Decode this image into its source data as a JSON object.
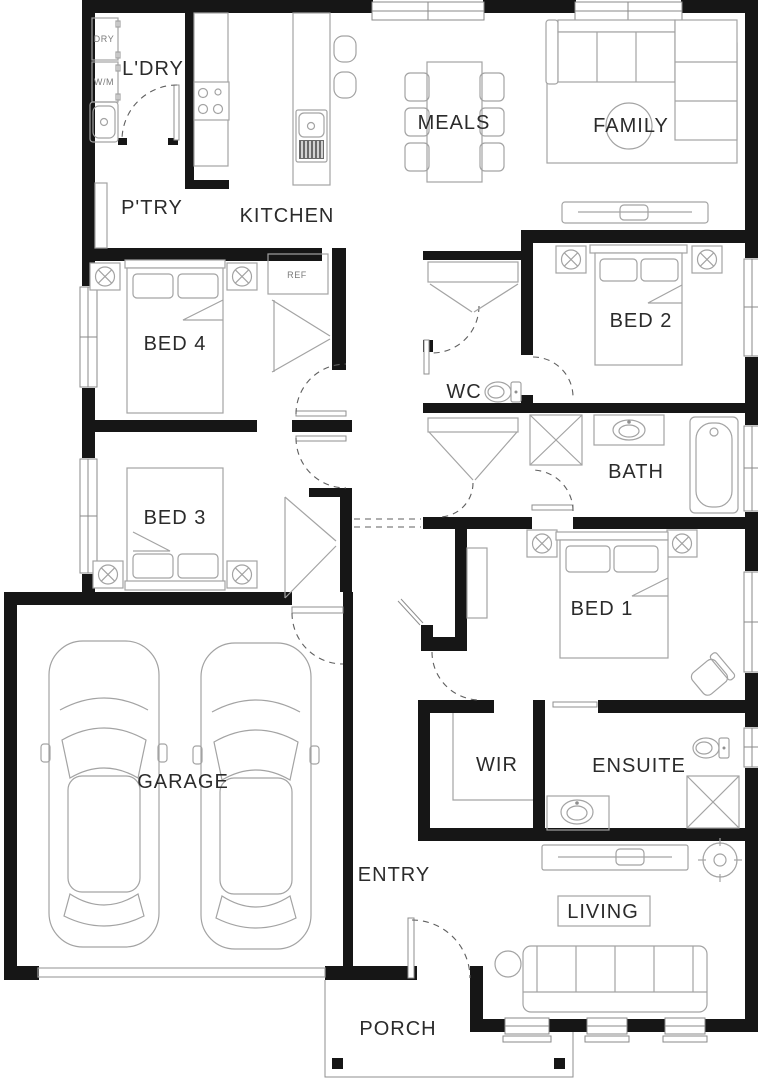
{
  "palette": {
    "wall": "#161616",
    "furniture_line": "#a3a3a3",
    "door_dash": "#5f5f5f",
    "label_text": "#2b2b2b",
    "small_label_text": "#7a7a7a",
    "background": "#ffffff"
  },
  "rooms": [
    {
      "id": "ldry",
      "label": "L'DRY"
    },
    {
      "id": "ptry",
      "label": "P'TRY"
    },
    {
      "id": "kitchen",
      "label": "KITCHEN"
    },
    {
      "id": "meals",
      "label": "MEALS"
    },
    {
      "id": "family",
      "label": "FAMILY"
    },
    {
      "id": "bed4",
      "label": "BED 4"
    },
    {
      "id": "bed2",
      "label": "BED 2"
    },
    {
      "id": "wc",
      "label": "WC"
    },
    {
      "id": "bath",
      "label": "BATH"
    },
    {
      "id": "bed3",
      "label": "BED 3"
    },
    {
      "id": "bed1",
      "label": "BED 1"
    },
    {
      "id": "garage",
      "label": "GARAGE"
    },
    {
      "id": "wir",
      "label": "WIR"
    },
    {
      "id": "ensuite",
      "label": "ENSUITE"
    },
    {
      "id": "entry",
      "label": "ENTRY"
    },
    {
      "id": "living",
      "label": "LIVING"
    },
    {
      "id": "porch",
      "label": "PORCH"
    }
  ],
  "fixtures": {
    "dryer": "DRY",
    "washer": "W/M",
    "fridge": "REF"
  }
}
